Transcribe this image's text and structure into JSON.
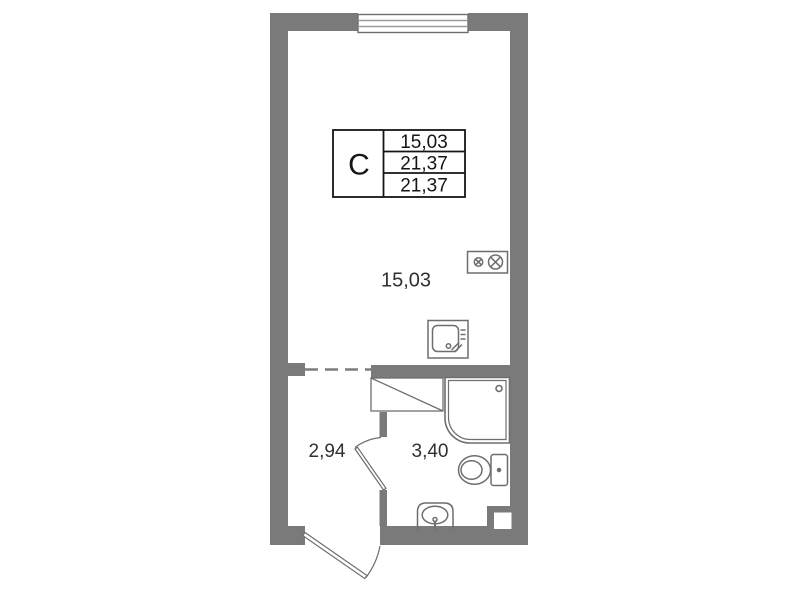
{
  "document": {
    "kind": "apartment-floor-plan"
  },
  "info_table": {
    "type_label": "С",
    "values": [
      "15,03",
      "21,37",
      "21,37"
    ]
  },
  "room_labels": {
    "main_room_area": "15,03",
    "hallway_area": "2,94",
    "bathroom_area": "3,40"
  },
  "fixtures": [
    "window",
    "stove-icon",
    "kitchen-sink-icon",
    "appliance-niche",
    "shower-cabin-icon",
    "toilet-icon",
    "washbasin-icon",
    "entrance-door",
    "bathroom-door",
    "vent-duct"
  ],
  "colors": {
    "wall": "#7a7a7a",
    "fixture_line": "#6e6e6e",
    "light_line": "#9a9a9a",
    "dashed_line": "#7d7d7d",
    "table_line": "#151515",
    "table_text": "#151515",
    "label_text": "#303030",
    "background": "#ffffff"
  }
}
